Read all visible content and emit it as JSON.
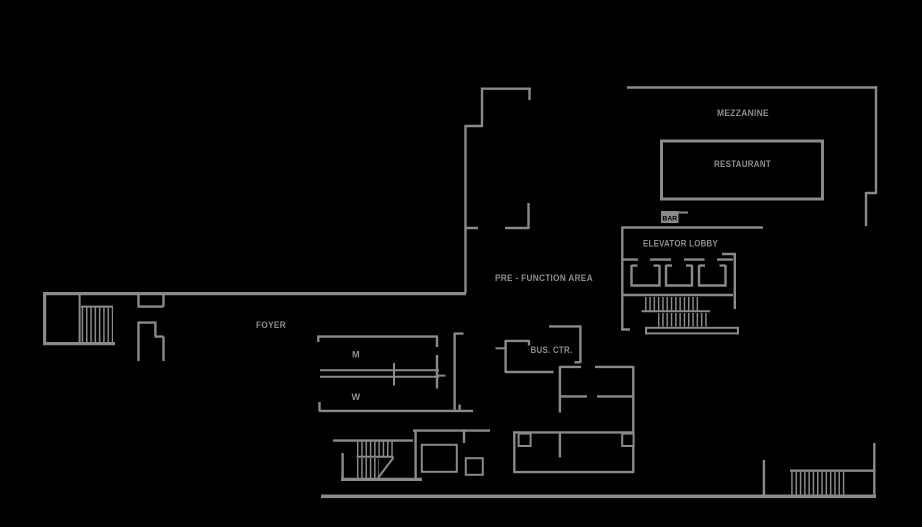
{
  "labels": {
    "mezzanine": "MEZZANINE",
    "restaurant": "RESTAURANT",
    "bar": "BAR",
    "elevator_lobby": "ELEVATOR LOBBY",
    "pre_function": "PRE - FUNCTION AREA",
    "foyer": "FOYER",
    "mens_room": "M",
    "womens_room": "W",
    "business_center": "BUS. CTR."
  },
  "colors": {
    "background": "#000000",
    "line": "#8a8a8a",
    "label": "#8f8f8f",
    "chip_text": "#000000"
  }
}
